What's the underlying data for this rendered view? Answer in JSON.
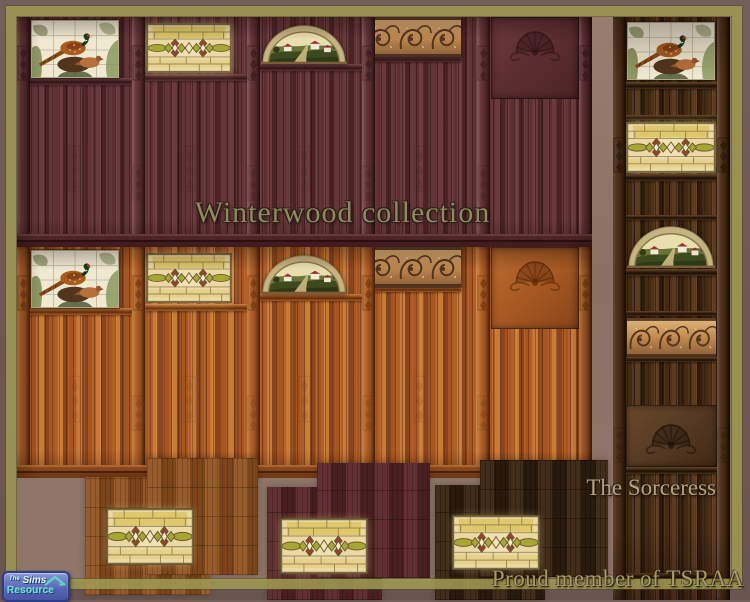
{
  "overlay": {
    "title": "Winterwood collection",
    "author": "The Sorceress",
    "membership": "Proud member of TSRAA"
  },
  "logo": {
    "prefix": "The",
    "name": "Sims",
    "product": "Resource"
  },
  "colors": {
    "frame_border": "#9e9852",
    "frame_edge": "#6e5952",
    "background": "#8d7365",
    "mahogany_wall": "#5e2e30",
    "oak_wall": "#b26028",
    "walnut_wall": "#4c3018",
    "oak_floor": "#8a4e1e",
    "mahogany_floor": "#552527",
    "dark_walnut_floor": "#33200e",
    "stained_glass_cream": "#ead9a4",
    "stained_glass_red": "#983f2d",
    "stained_glass_olive": "#a6a733",
    "carving_copper": "#c79a62",
    "title_text": "#8b8b5e",
    "author_text": "#b3a383"
  },
  "panels": [
    "pheasant-mural-tile",
    "stained-glass-window",
    "arched-landscape-window",
    "carved-acanthus-border",
    "carved-crest-panel"
  ]
}
